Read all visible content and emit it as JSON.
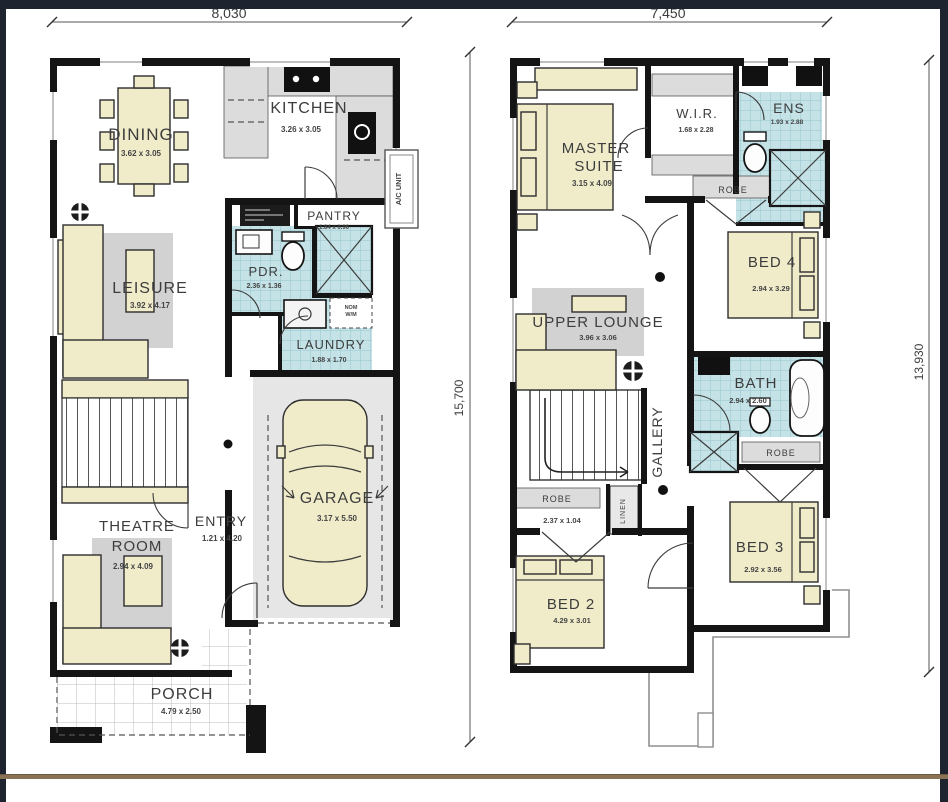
{
  "ground_floor": {
    "width_dim": "8,030",
    "rooms": {
      "dining": {
        "name": "DINING",
        "dim": "3.62 x 3.05"
      },
      "kitchen": {
        "name": "KITCHEN",
        "dim": "3.26 x 3.05"
      },
      "pantry": {
        "name": "PANTRY",
        "dim": "1.84 x 0.96"
      },
      "pdr": {
        "name": "PDR.",
        "dim": "2.36 x 1.36"
      },
      "laundry": {
        "name": "LAUNDRY",
        "dim": "1.88 x 1.70"
      },
      "leisure": {
        "name": "LEISURE",
        "dim": "3.92 x 4.17"
      },
      "theatre": {
        "name_line1": "THEATRE",
        "name_line2": "ROOM",
        "dim": "2.94 x 4.09"
      },
      "entry": {
        "name": "ENTRY",
        "dim": "1.21 x 4.20"
      },
      "garage": {
        "name": "GARAGE",
        "dim": "3.17 x 5.50"
      },
      "porch": {
        "name": "PORCH",
        "dim": "4.79 x 2.50"
      }
    },
    "annotations": {
      "ac_unit": "A/C UNIT",
      "wm_line1": "NOM",
      "wm_line2": "W/M"
    }
  },
  "first_floor": {
    "width_dim": "7,450",
    "height_dim_left": "15,700",
    "height_dim_right": "13,930",
    "rooms": {
      "master": {
        "name_line1": "MASTER",
        "name_line2": "SUITE",
        "dim": "3.15 x 4.09"
      },
      "wir": {
        "name": "W.I.R.",
        "dim": "1.68 x 2.28"
      },
      "ens": {
        "name": "ENS",
        "dim": "1.93 x 2.88"
      },
      "bed4": {
        "name": "BED 4",
        "dim": "2.94 x 3.29"
      },
      "upper_lounge": {
        "name": "UPPER LOUNGE",
        "dim": "3.96 x 3.06"
      },
      "bath": {
        "name": "BATH",
        "dim": "2.94 x 2.60"
      },
      "gallery": {
        "name": "GALLERY"
      },
      "bed3": {
        "name": "BED 3",
        "dim": "2.92 x 3.56"
      },
      "bed2": {
        "name": "BED 2",
        "dim": "4.29 x 3.01"
      },
      "robe_hall": {
        "name": "ROBE",
        "dim": "2.37 x 1.04"
      },
      "robe_bed4": {
        "name": "ROBE"
      },
      "robe_bed3": {
        "name": "ROBE"
      },
      "linen": {
        "name": "LINEN"
      }
    }
  }
}
